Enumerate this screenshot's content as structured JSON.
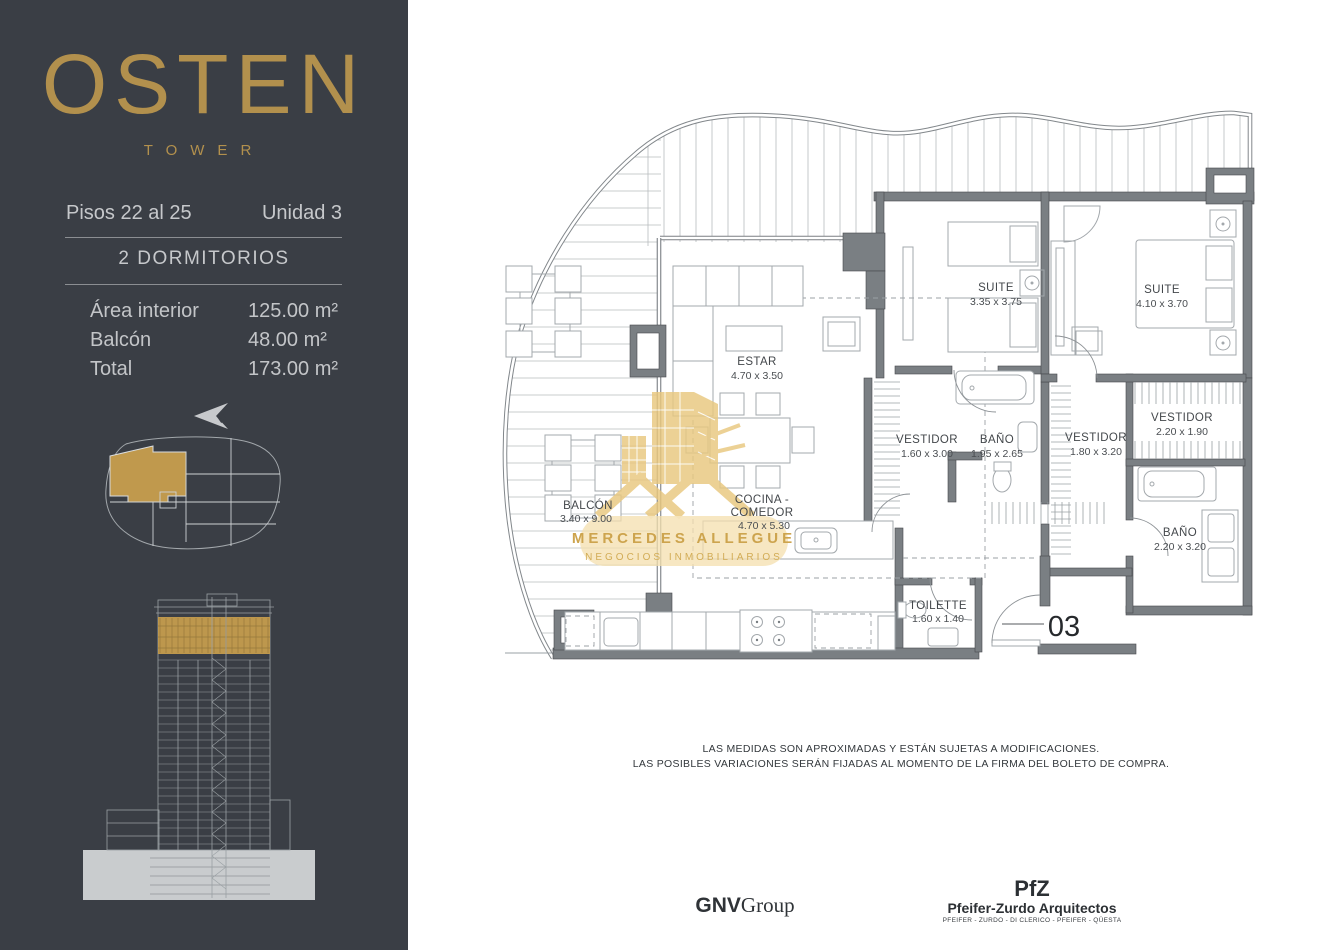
{
  "sidebar": {
    "brand": "OSTEN",
    "brand_sub": "TOWER",
    "floors_label": "Pisos 22 al 25",
    "unit_label": "Unidad 3",
    "type_label": "2 DORMITORIOS",
    "areas": [
      {
        "label": "Área interior",
        "value": "125.00 m²"
      },
      {
        "label": "Balcón",
        "value": "48.00 m²"
      },
      {
        "label": "Total",
        "value": "173.00 m²"
      }
    ],
    "north_letter": "N"
  },
  "plan": {
    "unit_number": "03",
    "rooms": {
      "estar": {
        "name": "ESTAR",
        "dims": "4.70 x 3.50"
      },
      "suite1": {
        "name": "SUITE",
        "dims": "3.35 x 3.75"
      },
      "suite2": {
        "name": "SUITE",
        "dims": "4.10 x 3.70"
      },
      "vestidor1": {
        "name": "VESTIDOR",
        "dims": "1.60 x 3.00"
      },
      "bano1": {
        "name": "BAÑO",
        "dims": "1.95 x 2.65"
      },
      "vestidor2": {
        "name": "VESTIDOR",
        "dims": "1.80 x 3.20"
      },
      "vestidor3": {
        "name": "VESTIDOR",
        "dims": "2.20 x 1.90"
      },
      "bano2": {
        "name": "BAÑO",
        "dims": "2.20 x 3.20"
      },
      "cocina": {
        "line1": "COCINA -",
        "line2": "COMEDOR",
        "dims": "4.70 x 5.30"
      },
      "balcon": {
        "name": "BALCÓN",
        "dims": "3.40 x 9.00"
      },
      "toilette": {
        "name": "TOILETTE",
        "dims": "1.60 x 1.40"
      }
    },
    "watermark": {
      "line1": "MERCEDES ALLEGUE",
      "line2": "NEGOCIOS INMOBILIARIOS"
    }
  },
  "footer": {
    "disclaimer1": "LAS MEDIDAS SON APROXIMADAS Y ESTÁN SUJETAS A MODIFICACIONES.",
    "disclaimer2": "LAS POSIBLES VARIACIONES SERÁN FIJADAS AL MOMENTO DE LA FIRMA DEL BOLETO DE COMPRA.",
    "gnv_bold": "GNV",
    "gnv_rest": "Group",
    "pfz": "PfZ",
    "pfz_name": "Pfeifer-Zurdo Arquitectos",
    "pfz_partners": "PFEIFER - ZURDO - DI CLERICO - PFEIFER - QÜESTA"
  },
  "colors": {
    "sidebar_bg": "#3a3e45",
    "gold": "#b2904d",
    "text_light": "#c6c8cb",
    "plan_wall": "#7a7f83",
    "watermark_gold": "#e9c87e"
  }
}
